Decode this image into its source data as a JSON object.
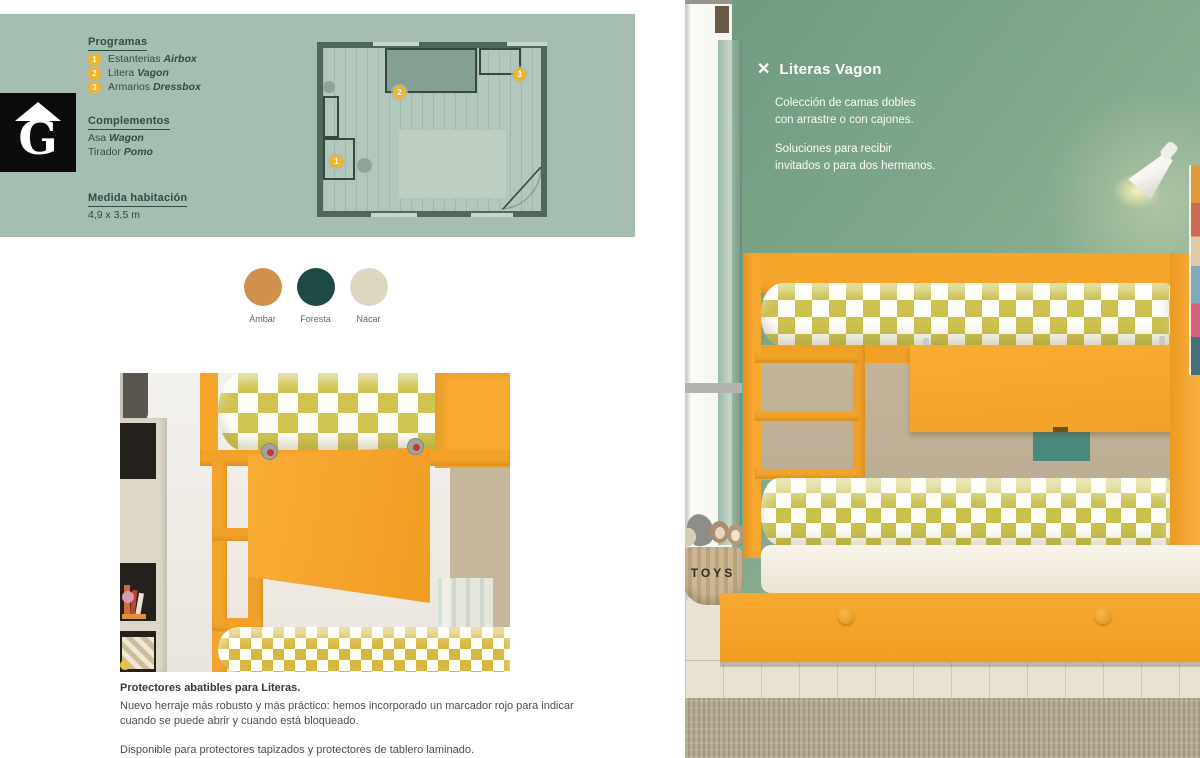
{
  "logo": {
    "letter": "G"
  },
  "panel": {
    "programas": {
      "title": "Programas",
      "items": [
        {
          "num": "1",
          "label": "Estanterias",
          "product": "Airbox"
        },
        {
          "num": "2",
          "label": "Litera",
          "product": "Vagon"
        },
        {
          "num": "3",
          "label": "Armarios",
          "product": "Dressbox"
        }
      ]
    },
    "complementos": {
      "title": "Complementos",
      "items": [
        {
          "label": "Asa",
          "product": "Wagon"
        },
        {
          "label": "Tirador",
          "product": "Pomo"
        }
      ]
    },
    "medida": {
      "title": "Medida habitación",
      "value": "4,9 x 3,5 m"
    },
    "plan_badges": {
      "b1": "1",
      "b2": "2",
      "b3": "3"
    }
  },
  "swatches": [
    {
      "name": "Ámbar",
      "color": "#d0914e"
    },
    {
      "name": "Foresta",
      "color": "#1d4a45"
    },
    {
      "name": "Nácar",
      "color": "#ddd7c1"
    }
  ],
  "photo": {
    "close_icon": "✕",
    "title": "Literas Vagon",
    "desc1_line1": "Colección de camas dobles",
    "desc1_line2": "con arrastre o con cajones.",
    "desc2_line1": "Soluciones para recibir",
    "desc2_line2": "invitados o para dos hermanos.",
    "basket_label": "TOYS"
  },
  "details": {
    "heading": "Protectores abatibles para Literas.",
    "p1": "Nuevo herraje más robusto y más práctico: hemos incorporado un marcador rojo para indicar cuando se puede abrir y cuando está bloqueado.",
    "p2": "Disponible para protectores tapizados y protectores de tablero laminado."
  },
  "colors": {
    "accent_amber": "#efb32c",
    "panel_green": "#a6beb1",
    "wall_green": "#85ab8e",
    "bed_orange": "#f6a82e",
    "mattress_diamond": "#ccc24d",
    "plan_wall": "#50675c",
    "text_dark_green": "#2e4d44"
  }
}
